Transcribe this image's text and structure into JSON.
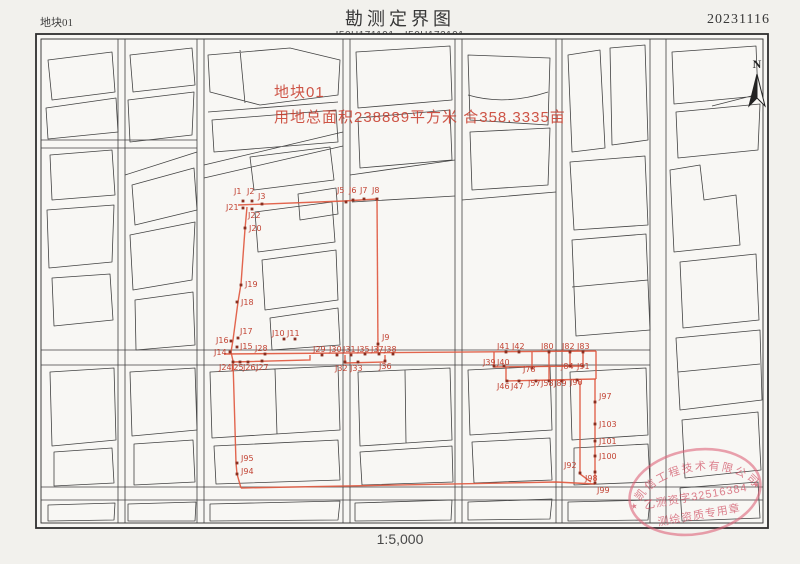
{
  "page": {
    "plot_label": "地块01",
    "title": "勘测定界图",
    "sheet_codes": "I50H171191、I50H172191",
    "date": "20231116",
    "scale": "1:5,000"
  },
  "map": {
    "north_label": "N",
    "annotation": {
      "line1": "地块01",
      "line2": "用地总面积238889平方米  合358.3335亩"
    },
    "stamp": {
      "company": "凯信工程技术有限公司",
      "license": "乙测资字32516384",
      "type": "测绘资质专用章",
      "star": "★"
    },
    "red_lines": [
      [
        [
          238,
          205
        ],
        [
          344,
          201
        ],
        [
          377,
          199
        ]
      ],
      [
        [
          247,
          207
        ],
        [
          245,
          229
        ],
        [
          241,
          284
        ],
        [
          238,
          302
        ],
        [
          233,
          340
        ],
        [
          231,
          352
        ],
        [
          233,
          361
        ],
        [
          236,
          463
        ],
        [
          237,
          474
        ],
        [
          241,
          488
        ]
      ],
      [
        [
          224,
          354
        ],
        [
          596,
          351
        ]
      ],
      [
        [
          377,
          199
        ],
        [
          378,
          352
        ]
      ],
      [
        [
          233,
          362
        ],
        [
          310,
          360
        ],
        [
          310,
          355
        ]
      ],
      [
        [
          345,
          355
        ],
        [
          345,
          363
        ],
        [
          385,
          362
        ],
        [
          385,
          355
        ]
      ],
      [
        [
          494,
          352
        ],
        [
          494,
          367
        ],
        [
          583,
          366
        ],
        [
          583,
          352
        ]
      ],
      [
        [
          506,
          367
        ],
        [
          506,
          381
        ],
        [
          596,
          379
        ]
      ],
      [
        [
          532,
          352
        ],
        [
          532,
          368
        ]
      ],
      [
        [
          549,
          352
        ],
        [
          549,
          381
        ]
      ],
      [
        [
          570,
          352
        ],
        [
          570,
          366
        ]
      ],
      [
        [
          596,
          351
        ],
        [
          596,
          379
        ]
      ],
      [
        [
          595,
          379
        ],
        [
          595,
          484
        ]
      ],
      [
        [
          580,
          381
        ],
        [
          580,
          474
        ],
        [
          591,
          482
        ]
      ],
      [
        [
          241,
          488
        ],
        [
          556,
          482
        ],
        [
          595,
          484
        ]
      ]
    ],
    "survey_points": [
      {
        "label": "J1",
        "x": 243,
        "y": 201,
        "lx": 234,
        "ly": 194
      },
      {
        "label": "J2",
        "x": 252,
        "y": 201,
        "lx": 247,
        "ly": 194
      },
      {
        "label": "J3",
        "x": 262,
        "y": 204,
        "lx": 258,
        "ly": 199
      },
      {
        "label": "J21",
        "x": 243,
        "y": 208,
        "lx": 226,
        "ly": 210
      },
      {
        "label": "J22",
        "x": 252,
        "y": 209,
        "lx": 248,
        "ly": 218
      },
      {
        "label": "J20",
        "x": 245,
        "y": 228,
        "lx": 249,
        "ly": 231
      },
      {
        "label": "J19",
        "x": 241,
        "y": 285,
        "lx": 245,
        "ly": 287
      },
      {
        "label": "J18",
        "x": 237,
        "y": 302,
        "lx": 241,
        "ly": 305
      },
      {
        "label": "J5",
        "x": 346,
        "y": 202,
        "lx": 337,
        "ly": 193
      },
      {
        "label": "J6",
        "x": 353,
        "y": 200,
        "lx": 349,
        "ly": 193
      },
      {
        "label": "J7",
        "x": 364,
        "y": 199,
        "lx": 360,
        "ly": 193
      },
      {
        "label": "J8",
        "x": 377,
        "y": 199,
        "lx": 372,
        "ly": 193
      },
      {
        "label": "J17",
        "x": 238,
        "y": 338,
        "lx": 240,
        "ly": 334
      },
      {
        "label": "J16",
        "x": 231,
        "y": 341,
        "lx": 216,
        "ly": 343
      },
      {
        "label": "J15",
        "x": 237,
        "y": 347,
        "lx": 240,
        "ly": 349
      },
      {
        "label": "J14",
        "x": 230,
        "y": 352,
        "lx": 214,
        "ly": 355
      },
      {
        "label": "J24",
        "x": 233,
        "y": 362,
        "lx": 219,
        "ly": 370
      },
      {
        "label": "J25",
        "x": 240,
        "y": 362,
        "lx": 231,
        "ly": 370
      },
      {
        "label": "J26",
        "x": 248,
        "y": 362,
        "lx": 243,
        "ly": 370
      },
      {
        "label": "J27",
        "x": 262,
        "y": 361,
        "lx": 256,
        "ly": 370
      },
      {
        "label": "J28",
        "x": 265,
        "y": 354,
        "lx": 255,
        "ly": 351
      },
      {
        "label": "J10",
        "x": 284,
        "y": 339,
        "lx": 272,
        "ly": 336
      },
      {
        "label": "J11",
        "x": 295,
        "y": 339,
        "lx": 287,
        "ly": 336
      },
      {
        "label": "J9",
        "x": 378,
        "y": 344,
        "lx": 382,
        "ly": 340
      },
      {
        "label": "J29",
        "x": 322,
        "y": 355,
        "lx": 313,
        "ly": 352
      },
      {
        "label": "J30",
        "x": 337,
        "y": 355,
        "lx": 329,
        "ly": 352
      },
      {
        "label": "J31",
        "x": 351,
        "y": 355,
        "lx": 343,
        "ly": 352
      },
      {
        "label": "J35",
        "x": 365,
        "y": 354,
        "lx": 357,
        "ly": 352
      },
      {
        "label": "J37",
        "x": 379,
        "y": 354,
        "lx": 371,
        "ly": 352
      },
      {
        "label": "J38",
        "x": 393,
        "y": 354,
        "lx": 384,
        "ly": 352
      },
      {
        "label": "J32",
        "x": 345,
        "y": 362,
        "lx": 335,
        "ly": 371
      },
      {
        "label": "J33",
        "x": 358,
        "y": 362,
        "lx": 350,
        "ly": 371
      },
      {
        "label": "J36",
        "x": 385,
        "y": 361,
        "lx": 379,
        "ly": 369
      },
      {
        "label": "J41",
        "x": 506,
        "y": 352,
        "lx": 497,
        "ly": 349
      },
      {
        "label": "J42",
        "x": 519,
        "y": 352,
        "lx": 512,
        "ly": 349
      },
      {
        "label": "J80",
        "x": 549,
        "y": 352,
        "lx": 541,
        "ly": 349
      },
      {
        "label": "J82",
        "x": 570,
        "y": 352,
        "lx": 562,
        "ly": 349
      },
      {
        "label": "J83",
        "x": 583,
        "y": 352,
        "lx": 577,
        "ly": 349
      },
      {
        "label": "J39",
        "x": 494,
        "y": 366,
        "lx": 483,
        "ly": 365
      },
      {
        "label": "J40",
        "x": 504,
        "y": 366,
        "lx": 497,
        "ly": 365
      },
      {
        "label": "J78",
        "x": 532,
        "y": 368,
        "lx": 523,
        "ly": 372
      },
      {
        "label": "J84",
        "x": 570,
        "y": 366,
        "lx": 561,
        "ly": 369
      },
      {
        "label": "J91",
        "x": 583,
        "y": 366,
        "lx": 577,
        "ly": 369
      },
      {
        "label": "J46",
        "x": 507,
        "y": 381,
        "lx": 497,
        "ly": 389
      },
      {
        "label": "J47",
        "x": 519,
        "y": 381,
        "lx": 511,
        "ly": 389
      },
      {
        "label": "J57",
        "x": 536,
        "y": 381,
        "lx": 528,
        "ly": 386
      },
      {
        "label": "J58",
        "x": 549,
        "y": 381,
        "lx": 541,
        "ly": 386
      },
      {
        "label": "J89",
        "x": 562,
        "y": 381,
        "lx": 554,
        "ly": 386
      },
      {
        "label": "J90",
        "x": 577,
        "y": 380,
        "lx": 570,
        "ly": 385
      },
      {
        "label": "J97",
        "x": 595,
        "y": 402,
        "lx": 599,
        "ly": 399
      },
      {
        "label": "J103",
        "x": 595,
        "y": 424,
        "lx": 599,
        "ly": 427
      },
      {
        "label": "J101",
        "x": 595,
        "y": 441,
        "lx": 599,
        "ly": 444
      },
      {
        "label": "J100",
        "x": 595,
        "y": 456,
        "lx": 599,
        "ly": 459
      },
      {
        "label": "J92",
        "x": 580,
        "y": 473,
        "lx": 564,
        "ly": 468
      },
      {
        "label": "J98",
        "x": 595,
        "y": 472,
        "lx": 585,
        "ly": 481
      },
      {
        "label": "J99",
        "x": 595,
        "y": 483,
        "lx": 597,
        "ly": 493
      },
      {
        "label": "J95",
        "x": 237,
        "y": 463,
        "lx": 241,
        "ly": 461
      },
      {
        "label": "J94",
        "x": 237,
        "y": 474,
        "lx": 241,
        "ly": 474
      }
    ]
  }
}
